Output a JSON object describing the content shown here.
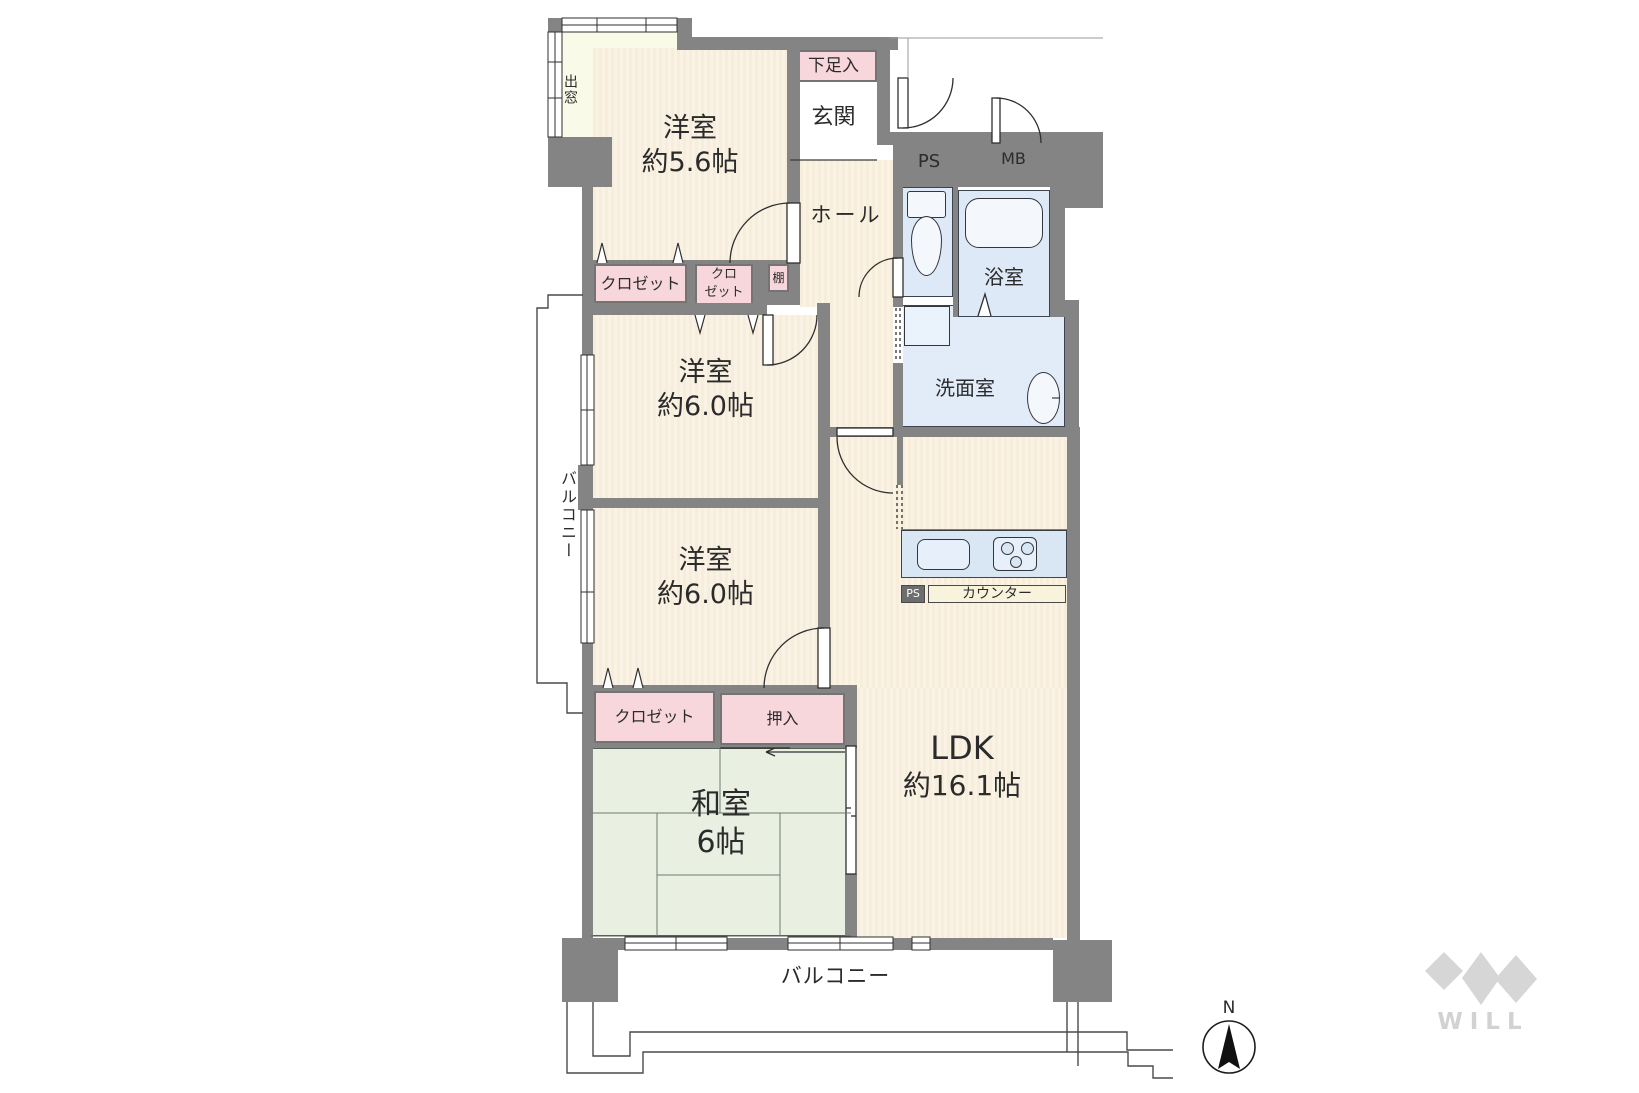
{
  "rooms": {
    "western_room_1": {
      "name": "洋室",
      "size": "約5.6帖"
    },
    "western_room_2": {
      "name": "洋室",
      "size": "約6.0帖"
    },
    "western_room_3": {
      "name": "洋室",
      "size": "約6.0帖"
    },
    "japanese_room": {
      "name": "和室",
      "size": "6帖"
    },
    "ldk": {
      "name": "LDK",
      "size": "約16.1帖"
    },
    "entrance": {
      "label": "玄関"
    },
    "hall": {
      "label": "ホール"
    },
    "bathroom": {
      "label": "浴室"
    },
    "washroom": {
      "label": "洗面室"
    }
  },
  "storage": {
    "shoe_cabinet": "下足入",
    "closet_1": "クロゼット",
    "closet_2": "クロ\nゼット",
    "shelf": "棚",
    "closet_3": "クロゼット",
    "oshiire": "押入"
  },
  "features": {
    "bay_window": "出窓",
    "balcony_left": "バルコニー",
    "balcony_bottom": "バルコニー",
    "counter": "カウンター",
    "ps_upper": "PS",
    "ps_lower": "PS",
    "mb": "MB"
  },
  "compass": {
    "north": "N"
  },
  "branding": {
    "logo_text": "WILL"
  },
  "colors": {
    "wall": "#848484",
    "floor_stripe": "#f6eedb",
    "tatami": "#e9f0e2",
    "water": "#dde9f6",
    "storage_pink": "#f8d7dc",
    "bay_cream": "#fafae8",
    "logo_gray": "#d6d6d6"
  }
}
